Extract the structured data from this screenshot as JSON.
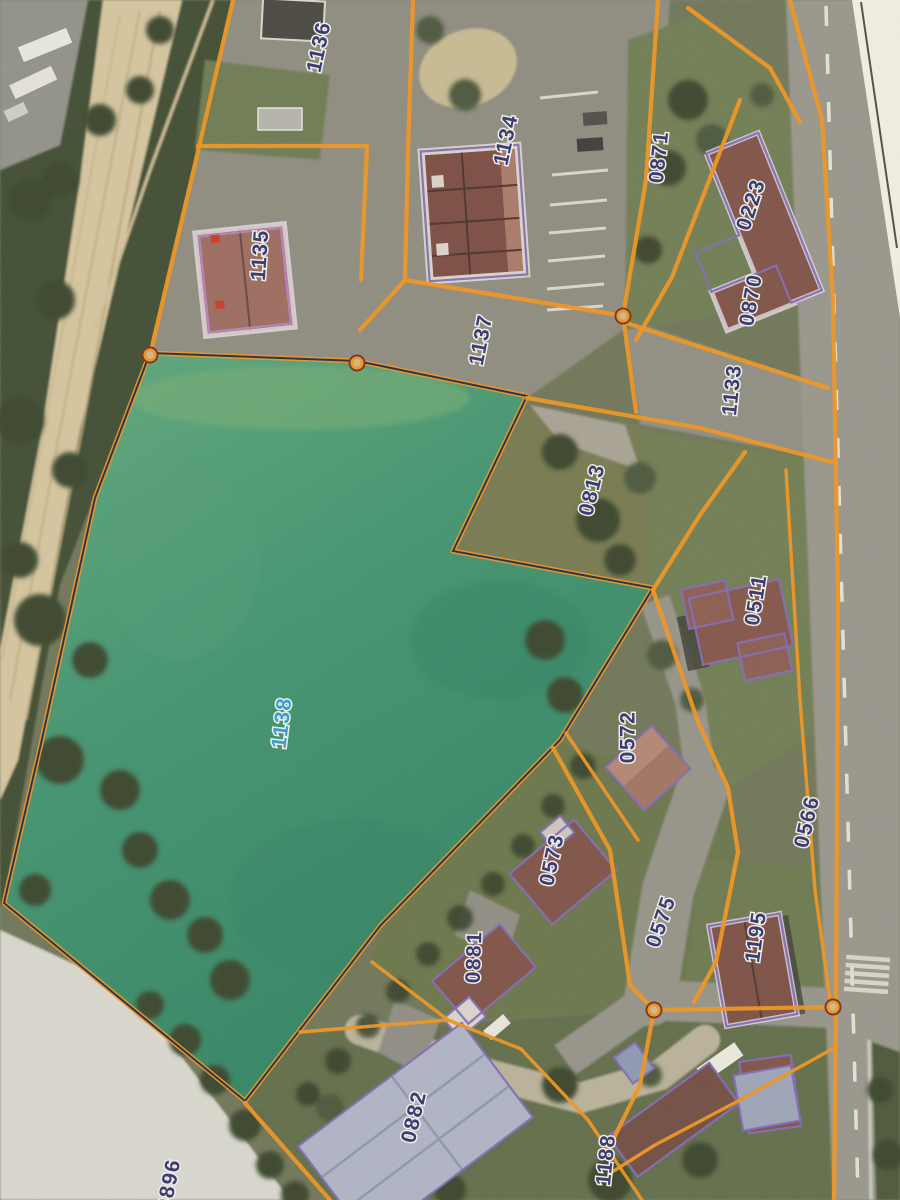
{
  "map": {
    "description": "Aerial cadastral plan photo with orange parcel boundaries and numbered parcels",
    "highlighted_parcel": {
      "id": "1138",
      "fill_top": "#5fa97e",
      "fill_bottom": "#2d8263",
      "label_color": "#2e9bd6"
    },
    "parcel_labels": [
      {
        "id": "1136",
        "x": 320,
        "y": 47,
        "rot": -78
      },
      {
        "id": "1134",
        "x": 507,
        "y": 140,
        "rot": -78
      },
      {
        "id": "0871",
        "x": 660,
        "y": 157,
        "rot": -84
      },
      {
        "id": "0223",
        "x": 752,
        "y": 205,
        "rot": -72
      },
      {
        "id": "1135",
        "x": 261,
        "y": 255,
        "rot": -86
      },
      {
        "id": "0870",
        "x": 752,
        "y": 300,
        "rot": -80
      },
      {
        "id": "1137",
        "x": 482,
        "y": 340,
        "rot": -79
      },
      {
        "id": "1133",
        "x": 733,
        "y": 390,
        "rot": -84
      },
      {
        "id": "0813",
        "x": 593,
        "y": 490,
        "rot": -76
      },
      {
        "id": "0511",
        "x": 757,
        "y": 600,
        "rot": -81
      },
      {
        "id": "1138",
        "x": 283,
        "y": 723,
        "rot": -83,
        "color": "#2e9bd6"
      },
      {
        "id": "0572",
        "x": 629,
        "y": 737,
        "rot": -90
      },
      {
        "id": "0566",
        "x": 808,
        "y": 822,
        "rot": -77
      },
      {
        "id": "0573",
        "x": 553,
        "y": 860,
        "rot": -78
      },
      {
        "id": "0575",
        "x": 662,
        "y": 922,
        "rot": -71
      },
      {
        "id": "0881",
        "x": 475,
        "y": 957,
        "rot": -88
      },
      {
        "id": "1195",
        "x": 757,
        "y": 937,
        "rot": -82
      },
      {
        "id": "0882",
        "x": 415,
        "y": 1117,
        "rot": -77
      },
      {
        "id": "1188",
        "x": 607,
        "y": 1160,
        "rot": -84
      },
      {
        "id": "0896",
        "x": 170,
        "y": 1185,
        "rot": -79
      }
    ],
    "vertex_markers": [
      {
        "x": 150,
        "y": 355
      },
      {
        "x": 357,
        "y": 363
      },
      {
        "x": 623,
        "y": 316
      },
      {
        "x": 654,
        "y": 1010
      },
      {
        "x": 833,
        "y": 1007
      }
    ],
    "colors": {
      "orange_boundary": "#ef941c",
      "parcel_label_navy": "#2f3170",
      "parcel_label_highlight": "#2e9bd6",
      "building_outline_purple": "#7f68b8",
      "building_outline_halo": "#eae6f2",
      "label_halo": "#f2f2ea",
      "road_gray": "#97968d",
      "railway_tan": "#d5c6a0"
    }
  }
}
